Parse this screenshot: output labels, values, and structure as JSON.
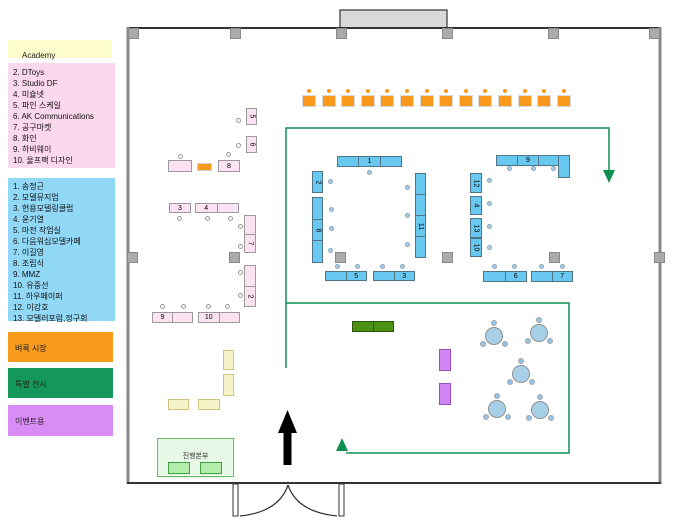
{
  "legend": {
    "academy_label": "Academy",
    "academy_color": "#fcfccc",
    "pink_color": "#fcd8ee",
    "pink_items": [
      "2. DToys",
      "3. Studio DF",
      "4. 미슐넷",
      "5. 파인 스케일",
      "6. AK Communications",
      "7. 공구마켓",
      "8. 화인",
      "9. 하비웨이",
      "10. 울프팩 디자인"
    ],
    "blue_color": "#90d8f6",
    "blue_items": [
      "1. 송정근",
      "2. 모델뮤지엄",
      "3. 현용모델링클럽",
      "4. 윤기열",
      "5. 마전 작업실",
      "6. 다음워십모델카페",
      "7. 이길영",
      "8. 조립식",
      "9. MMZ",
      "10. 유중선",
      "11. 하우페이퍼",
      "12. 이강호",
      "13. 모델러포럼,정구회"
    ],
    "flea_label": "벼룩 시장",
    "flea_color": "#f89a1c",
    "special_label": "특별 전시",
    "special_color": "#14975a",
    "event_label": "이벤트용",
    "event_color": "#d98cf5"
  },
  "floor": {
    "hq_label": "진행본부",
    "stage": {
      "x": 340,
      "y": 10,
      "w": 107,
      "h": 18,
      "color": "#d9d9d9"
    },
    "stalls": {
      "count": 14,
      "x0": 302,
      "pitch": 19.6,
      "y": 95,
      "w": 14,
      "h": 12,
      "color": "#f8981d"
    },
    "pillars": {
      "top_row": {
        "y": 28,
        "xs": [
          128,
          230,
          336,
          442,
          548,
          649
        ]
      },
      "mid_row": {
        "y": 252,
        "xs": [
          127,
          229,
          335,
          442,
          549,
          654
        ]
      }
    },
    "tables": [
      {
        "type": "pink",
        "x": 168,
        "y": 160,
        "w": 24,
        "h": 12,
        "vert": false,
        "cells": [
          ""
        ]
      },
      {
        "type": "orange",
        "x": 197,
        "y": 163,
        "w": 15,
        "h": 8,
        "vert": false,
        "cells": [
          ""
        ]
      },
      {
        "type": "pink",
        "x": 218,
        "y": 160,
        "w": 22,
        "h": 12,
        "vert": false,
        "cells": [
          "8"
        ]
      },
      {
        "type": "pink",
        "x": 246,
        "y": 108,
        "w": 11,
        "h": 17,
        "vert": true,
        "cells": [
          "5"
        ]
      },
      {
        "type": "pink",
        "x": 246,
        "y": 136,
        "w": 11,
        "h": 17,
        "vert": true,
        "cells": [
          "6"
        ]
      },
      {
        "type": "pink",
        "x": 169,
        "y": 203,
        "w": 22,
        "h": 10,
        "vert": false,
        "cells": [
          "3"
        ]
      },
      {
        "type": "pink",
        "x": 195,
        "y": 203,
        "w": 44,
        "h": 10,
        "vert": false,
        "cells": [
          "4",
          ""
        ]
      },
      {
        "type": "pink",
        "x": 244,
        "y": 215,
        "w": 12,
        "h": 38,
        "vert": true,
        "cells": [
          "",
          "7"
        ]
      },
      {
        "type": "pink",
        "x": 244,
        "y": 265,
        "w": 12,
        "h": 42,
        "vert": true,
        "cells": [
          "",
          "2"
        ]
      },
      {
        "type": "pink",
        "x": 152,
        "y": 312,
        "w": 41,
        "h": 11,
        "vert": false,
        "cells": [
          "9",
          ""
        ]
      },
      {
        "type": "pink",
        "x": 198,
        "y": 312,
        "w": 42,
        "h": 11,
        "vert": false,
        "cells": [
          "10",
          ""
        ]
      },
      {
        "type": "blue",
        "x": 337,
        "y": 156,
        "w": 65,
        "h": 11,
        "vert": false,
        "cells": [
          "",
          "1",
          ""
        ]
      },
      {
        "type": "blue",
        "x": 312,
        "y": 171,
        "w": 11,
        "h": 22,
        "vert": true,
        "cells": [
          "2"
        ]
      },
      {
        "type": "blue",
        "x": 312,
        "y": 197,
        "w": 11,
        "h": 66,
        "vert": true,
        "cells": [
          "",
          "8",
          ""
        ]
      },
      {
        "type": "blue",
        "x": 415,
        "y": 173,
        "w": 11,
        "h": 85,
        "vert": true,
        "cells": [
          "",
          "",
          "11",
          ""
        ]
      },
      {
        "type": "blue",
        "x": 325,
        "y": 271,
        "w": 42,
        "h": 10,
        "vert": false,
        "cells": [
          "",
          "5"
        ]
      },
      {
        "type": "blue",
        "x": 373,
        "y": 271,
        "w": 42,
        "h": 10,
        "vert": false,
        "cells": [
          "",
          "3"
        ]
      },
      {
        "type": "blue",
        "x": 496,
        "y": 155,
        "w": 64,
        "h": 11,
        "vert": false,
        "cells": [
          "",
          "9",
          ""
        ]
      },
      {
        "type": "blue",
        "x": 558,
        "y": 155,
        "w": 12,
        "h": 23,
        "vert": true,
        "cells": [
          ""
        ]
      },
      {
        "type": "blue",
        "x": 470,
        "y": 173,
        "w": 12,
        "h": 20,
        "vert": true,
        "cells": [
          "12"
        ]
      },
      {
        "type": "blue",
        "x": 470,
        "y": 196,
        "w": 12,
        "h": 19,
        "vert": true,
        "cells": [
          "4"
        ]
      },
      {
        "type": "blue",
        "x": 470,
        "y": 218,
        "w": 12,
        "h": 20,
        "vert": true,
        "cells": [
          "13"
        ]
      },
      {
        "type": "blue",
        "x": 470,
        "y": 238,
        "w": 12,
        "h": 19,
        "vert": true,
        "cells": [
          "10"
        ]
      },
      {
        "type": "blue",
        "x": 483,
        "y": 271,
        "w": 44,
        "h": 11,
        "vert": false,
        "cells": [
          "",
          "6"
        ]
      },
      {
        "type": "blue",
        "x": 531,
        "y": 271,
        "w": 42,
        "h": 11,
        "vert": false,
        "cells": [
          "",
          "7"
        ]
      },
      {
        "type": "dgreen",
        "x": 352,
        "y": 321,
        "w": 42,
        "h": 11,
        "vert": false,
        "cells": [
          "",
          ""
        ]
      },
      {
        "type": "purple",
        "x": 439,
        "y": 349,
        "w": 12,
        "h": 22,
        "vert": true,
        "cells": [
          ""
        ]
      },
      {
        "type": "purple",
        "x": 439,
        "y": 383,
        "w": 12,
        "h": 22,
        "vert": true,
        "cells": [
          ""
        ]
      },
      {
        "type": "yellow",
        "x": 223,
        "y": 350,
        "w": 11,
        "h": 20,
        "vert": true,
        "cells": [
          ""
        ]
      },
      {
        "type": "yellow",
        "x": 223,
        "y": 374,
        "w": 11,
        "h": 22,
        "vert": true,
        "cells": [
          ""
        ]
      },
      {
        "type": "yellow",
        "x": 168,
        "y": 399,
        "w": 21,
        "h": 11,
        "vert": false,
        "cells": [
          ""
        ]
      },
      {
        "type": "yellow",
        "x": 198,
        "y": 399,
        "w": 22,
        "h": 11,
        "vert": false,
        "cells": [
          ""
        ]
      },
      {
        "type": "hq",
        "x": 168,
        "y": 462,
        "w": 22,
        "h": 12,
        "vert": false,
        "cells": [
          ""
        ]
      },
      {
        "type": "hq",
        "x": 200,
        "y": 462,
        "w": 22,
        "h": 12,
        "vert": false,
        "cells": [
          ""
        ]
      }
    ],
    "chairs": {
      "open": [
        [
          180,
          156
        ],
        [
          228,
          154
        ],
        [
          238,
          120
        ],
        [
          238,
          145
        ],
        [
          179,
          218
        ],
        [
          207,
          218
        ],
        [
          230,
          218
        ],
        [
          240,
          226
        ],
        [
          240,
          246
        ],
        [
          240,
          272
        ],
        [
          240,
          295
        ],
        [
          162,
          306
        ],
        [
          183,
          306
        ],
        [
          208,
          306
        ],
        [
          227,
          306
        ]
      ],
      "blue": [
        [
          369,
          172
        ],
        [
          330,
          181
        ],
        [
          331,
          209
        ],
        [
          331,
          228
        ],
        [
          330,
          250
        ],
        [
          407,
          187
        ],
        [
          407,
          215
        ],
        [
          407,
          244
        ],
        [
          337,
          266
        ],
        [
          357,
          266
        ],
        [
          382,
          266
        ],
        [
          402,
          266
        ],
        [
          509,
          168
        ],
        [
          533,
          168
        ],
        [
          553,
          168
        ],
        [
          489,
          180
        ],
        [
          489,
          203
        ],
        [
          489,
          226
        ],
        [
          489,
          247
        ],
        [
          494,
          266
        ],
        [
          514,
          266
        ],
        [
          541,
          266
        ],
        [
          562,
          266
        ]
      ]
    },
    "round_tables": {
      "centers": [
        [
          494,
          336
        ],
        [
          539,
          333
        ],
        [
          521,
          374
        ],
        [
          497,
          409
        ],
        [
          540,
          410
        ]
      ],
      "radius": 9,
      "seat_offsets": [
        [
          0,
          -13
        ],
        [
          -11,
          8
        ],
        [
          11,
          8
        ]
      ]
    }
  },
  "colors": {
    "flow_line": "#0e9150",
    "wall_dark": "#333333",
    "wall_gray": "#878787",
    "entrance_arrow": "#000000"
  }
}
